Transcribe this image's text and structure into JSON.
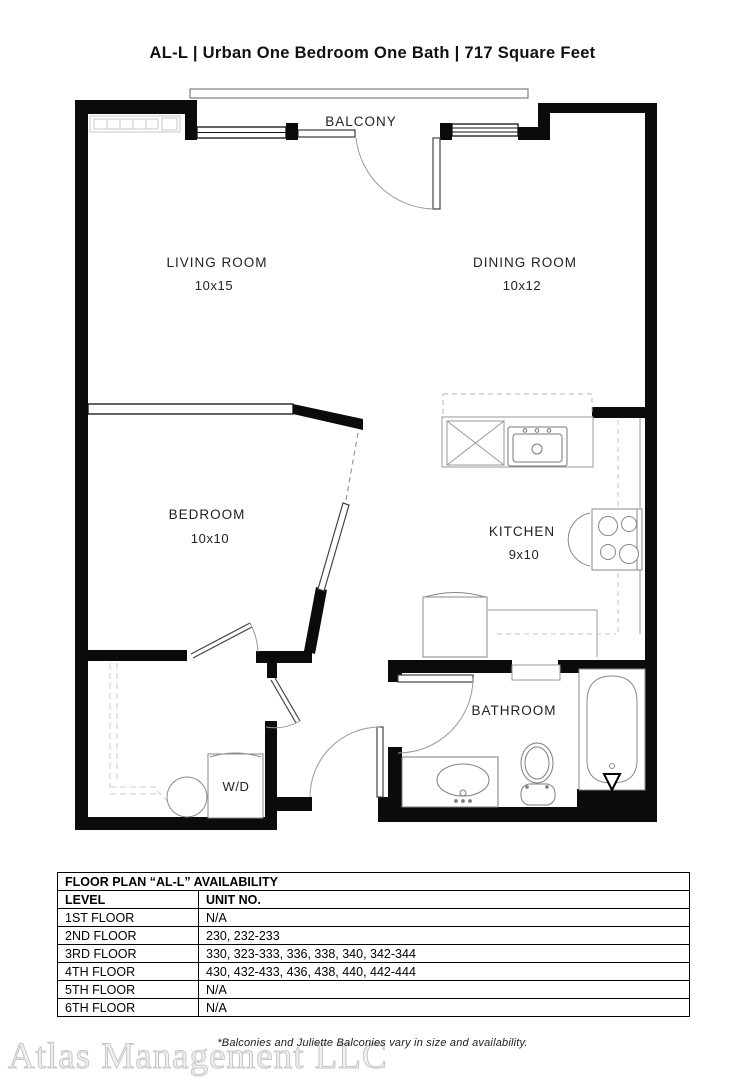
{
  "title": "AL-L | Urban One Bedroom One Bath | 717  Square Feet",
  "floorplan": {
    "balcony_label": "BALCONY",
    "rooms": {
      "living": {
        "name": "LIVING ROOM",
        "dims": "10x15"
      },
      "dining": {
        "name": "DINING ROOM",
        "dims": "10x12"
      },
      "bedroom": {
        "name": "BEDROOM",
        "dims": "10x10"
      },
      "kitchen": {
        "name": "KITCHEN",
        "dims": "9x10"
      },
      "bathroom": {
        "name": "BATHROOM"
      },
      "laundry": {
        "name": "W/D"
      }
    }
  },
  "availability": {
    "title": "FLOOR PLAN “AL-L” AVAILABILITY",
    "columns": {
      "level": "LEVEL",
      "units": "UNIT NO."
    },
    "rows": [
      {
        "level": "1ST FLOOR",
        "units": "N/A"
      },
      {
        "level": "2ND FLOOR",
        "units": "230, 232-233"
      },
      {
        "level": "3RD FLOOR",
        "units": "330, 323-333, 336, 338, 340, 342-344"
      },
      {
        "level": "4TH FLOOR",
        "units": "430, 432-433, 436, 438, 440, 442-444"
      },
      {
        "level": "5TH FLOOR",
        "units": "N/A"
      },
      {
        "level": "6TH FLOOR",
        "units": "N/A"
      }
    ]
  },
  "footnote": "*Balconies and Juliette Balconies vary in size and availability.",
  "watermark": "Atlas Management LLC",
  "colors": {
    "wall": "#0b0b0b",
    "fixture": "#8a8a8a",
    "dashed": "#bbbbbb"
  }
}
